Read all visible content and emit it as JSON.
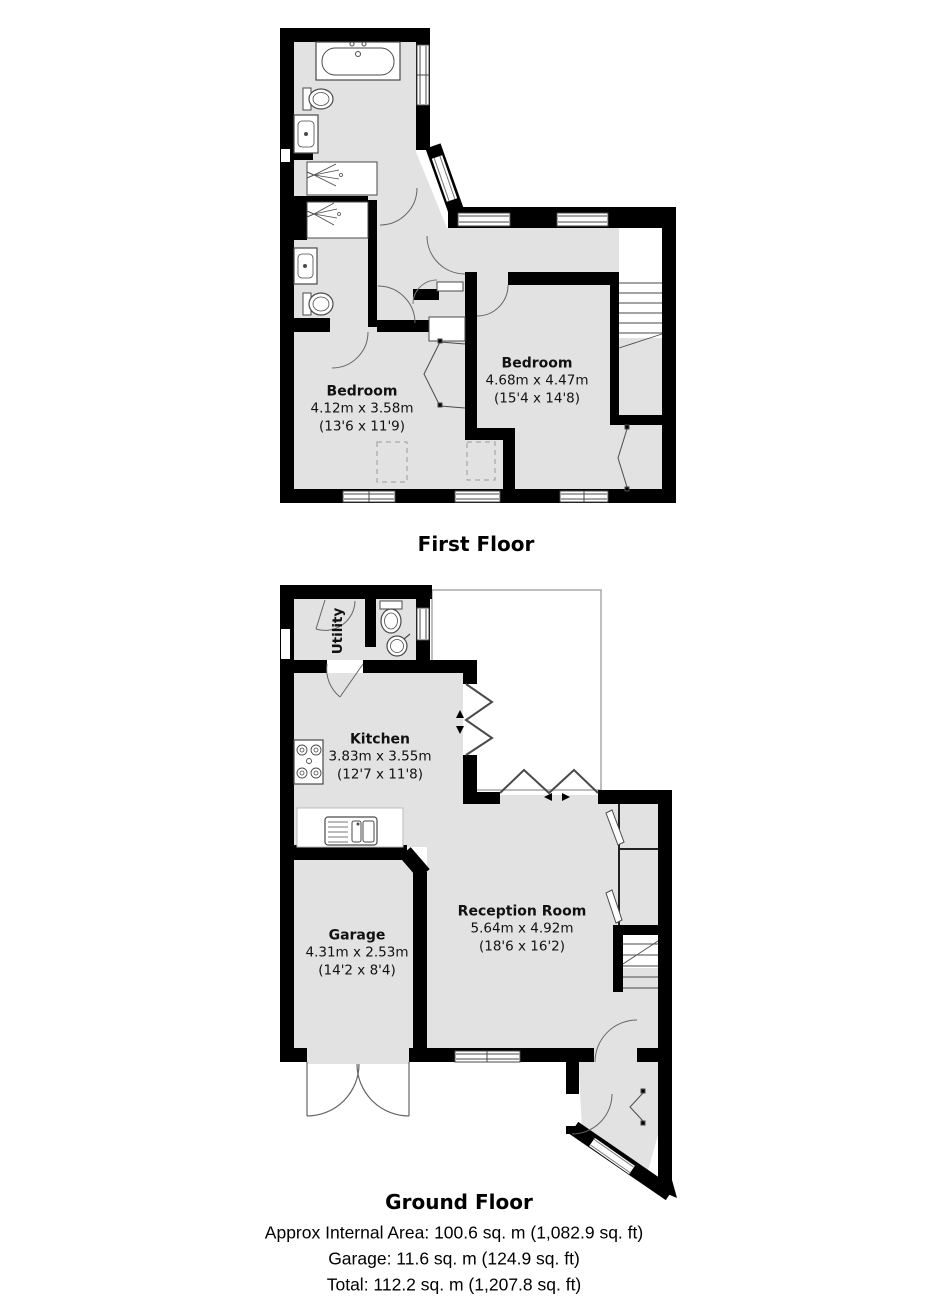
{
  "document_type": "floorplan",
  "colors": {
    "wall": "#000000",
    "floor": "#e2e2e2",
    "fixture_line": "#4a4a4a",
    "terrace_outline": "#a8a8a8",
    "text": "#111111"
  },
  "first_floor": {
    "title": "First Floor",
    "rooms": {
      "bedroom_left": {
        "name": "Bedroom",
        "metric": "4.12m x 3.58m",
        "imperial": "(13'6 x 11'9)"
      },
      "bedroom_right": {
        "name": "Bedroom",
        "metric": "4.68m x 4.47m",
        "imperial": "(15'4 x 14'8)"
      }
    }
  },
  "ground_floor": {
    "title": "Ground Floor",
    "rooms": {
      "utility": {
        "name": "Utility"
      },
      "kitchen": {
        "name": "Kitchen",
        "metric": "3.83m x 3.55m",
        "imperial": "(12'7 x 11'8)"
      },
      "garage": {
        "name": "Garage",
        "metric": "4.31m x 2.53m",
        "imperial": "(14'2 x 8'4)"
      },
      "reception": {
        "name": "Reception Room",
        "metric": "5.64m x 4.92m",
        "imperial": "(18'6 x 16'2)"
      }
    }
  },
  "summary": {
    "internal_area": "Approx Internal Area: 100.6 sq. m (1,082.9 sq. ft)",
    "garage_area": "Garage: 11.6 sq. m (124.9 sq. ft)",
    "total_area": "Total: 112.2 sq. m (1,207.8 sq. ft)"
  }
}
